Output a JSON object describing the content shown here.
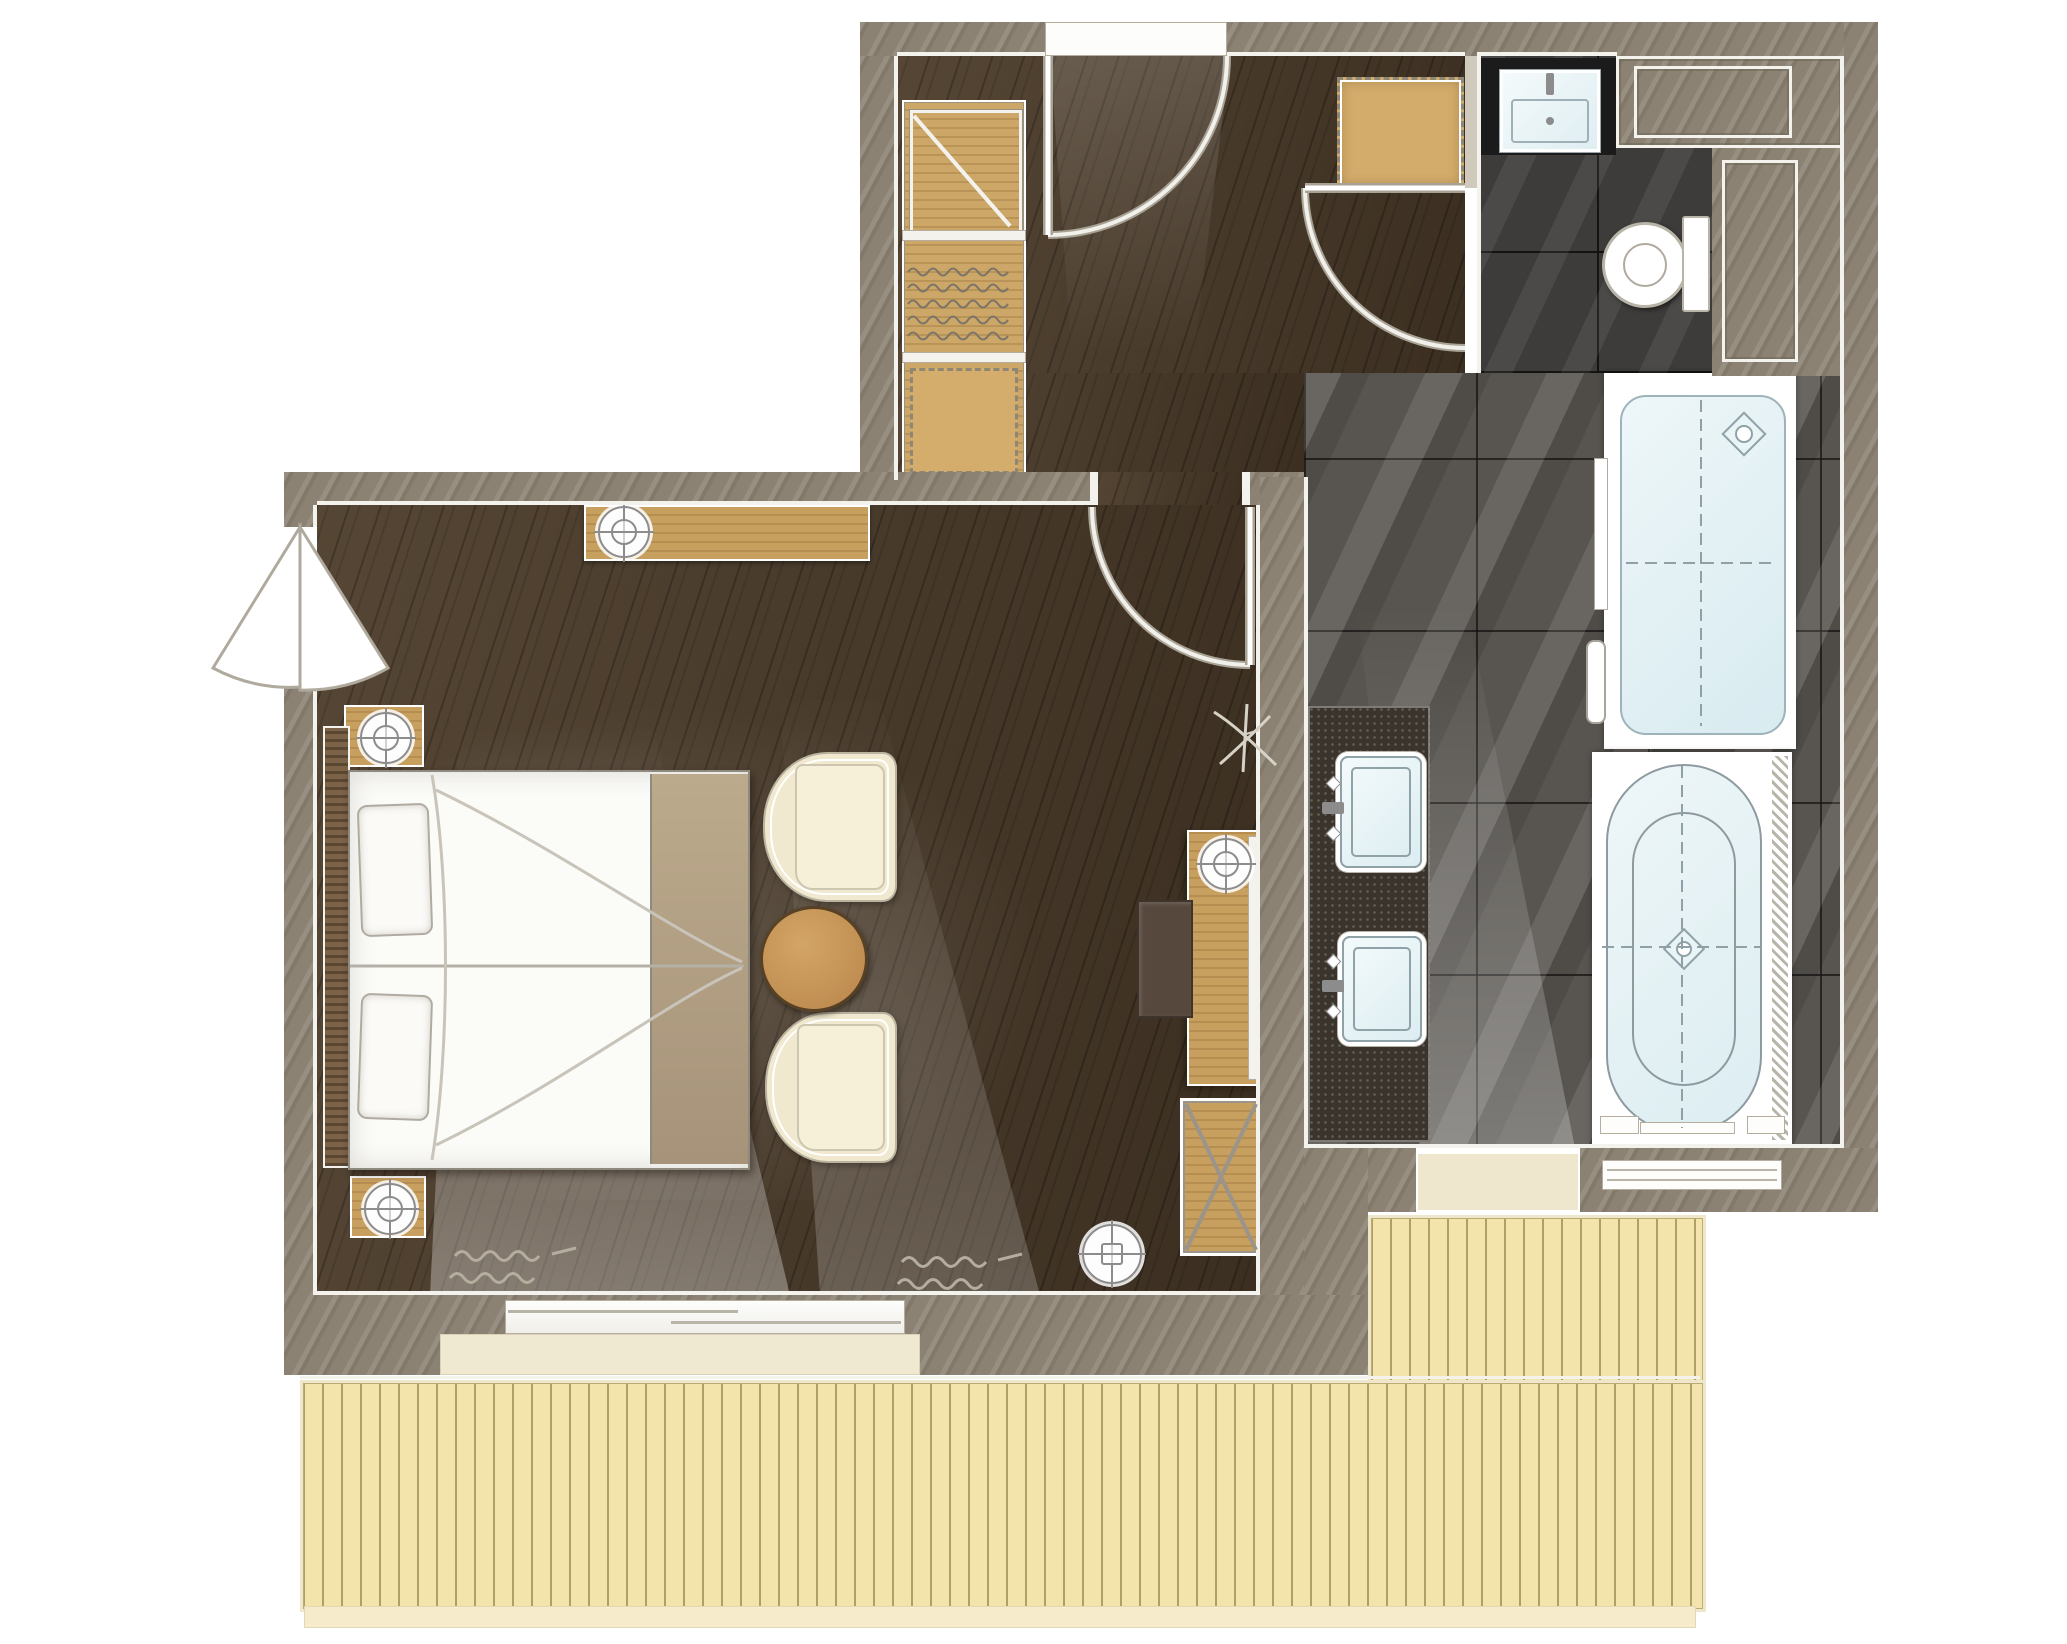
{
  "scene": {
    "type": "architectural-floor-plan",
    "label": "Hotel suite floor plan, top-down rendered view, no text labels",
    "width_px": 2067,
    "height_px": 1644
  },
  "colors": {
    "page-bg": "#ffffff",
    "wall": "#8b8273",
    "wall-shade": "#6e6556",
    "trim": "#f4f2ec",
    "wood-floor": "#4c3c2a",
    "closet-wood": "#cda767",
    "bench-wood": "#d3ab6b",
    "console-wood": "#c79f5f",
    "table-wood": "#c0914f",
    "headboard-wood": "#7c6347",
    "bed-white": "#fbfbf8",
    "bed-runner": "#b3a084",
    "chair-cream": "#f1e9cf",
    "stool-brown": "#57483e",
    "tile-dark": "#3e3c3a",
    "tile-gray": "#585550",
    "counter-black": "#1b1b1b",
    "granite": "#3a342d",
    "fixture-blue": "#e9f4f6",
    "fixture-line": "#8fa2a8",
    "deck-wood": "#f2e4aa",
    "deck-line": "#a89558",
    "deck-edge": "#efe7cb",
    "arc-line": "#d8d4ca",
    "symbol-gray": "#8c8c8c"
  },
  "rooms": [
    {
      "id": "entry-hall",
      "label": "Entry hall",
      "floor": "dark wood"
    },
    {
      "id": "bedroom",
      "label": "Bedroom and sitting area",
      "floor": "dark wood"
    },
    {
      "id": "wc",
      "label": "Toilet room",
      "floor": "dark charcoal tile"
    },
    {
      "id": "bathroom",
      "label": "Bathroom",
      "floor": "gray stone tile"
    },
    {
      "id": "terrace",
      "label": "Wood plank terrace",
      "floor": "light decking"
    }
  ],
  "fixtures": [
    {
      "id": "wardrobe",
      "label": "Wardrobe with shelf, hanging rail and drawer unit"
    },
    {
      "id": "bench",
      "label": "Square upholstered luggage bench"
    },
    {
      "id": "wc-basin",
      "label": "Washbasin on black counter"
    },
    {
      "id": "toilet",
      "label": "Toilet with cistern"
    },
    {
      "id": "shower",
      "label": "Walk-in shower with drain"
    },
    {
      "id": "bathtub",
      "label": "Oval bathtub with center drain"
    },
    {
      "id": "vanity",
      "label": "Double vanity with two basins"
    },
    {
      "id": "towel-rail",
      "label": "Towel rail"
    },
    {
      "id": "bed",
      "label": "Double bed with two pillows and foot runner"
    },
    {
      "id": "nightstand-1",
      "label": "Nightstand with lamp"
    },
    {
      "id": "nightstand-2",
      "label": "Nightstand with lamp"
    },
    {
      "id": "wall-console",
      "label": "Wall console with lamp"
    },
    {
      "id": "armchair-1",
      "label": "Barrel armchair"
    },
    {
      "id": "armchair-2",
      "label": "Barrel armchair"
    },
    {
      "id": "side-table",
      "label": "Round wooden side table"
    },
    {
      "id": "desk-console",
      "label": "Desk console with lamp"
    },
    {
      "id": "stool",
      "label": "Desk stool"
    },
    {
      "id": "luggage-rack",
      "label": "Folding luggage rack"
    },
    {
      "id": "floor-lamp",
      "label": "Floor lamp"
    }
  ],
  "doors": [
    {
      "id": "entry-door",
      "label": "Entry door swinging into hall"
    },
    {
      "id": "bedroom-door",
      "label": "Door from hall into bedroom area"
    },
    {
      "id": "wc-door",
      "label": "Door into toilet/bath zone"
    },
    {
      "id": "balcony-door",
      "label": "Double-acting corner door to outside"
    },
    {
      "id": "sliding-door",
      "label": "Sliding glass door to terrace"
    },
    {
      "id": "terrace-threshold",
      "label": "Bathroom threshold opening to terrace"
    }
  ],
  "symbols": [
    {
      "name": "lamp-target-icon",
      "meaning": "light fixture symbol (circle with crosshair)"
    },
    {
      "name": "drain-icon",
      "meaning": "rotated square drain symbol"
    },
    {
      "name": "curtain-squiggle-icon",
      "meaning": "curtain fabric squiggle"
    },
    {
      "name": "plant-sprig-icon",
      "meaning": "decorative sprig on floor"
    },
    {
      "name": "door-swing-arc",
      "meaning": "door swing quarter arc"
    }
  ]
}
